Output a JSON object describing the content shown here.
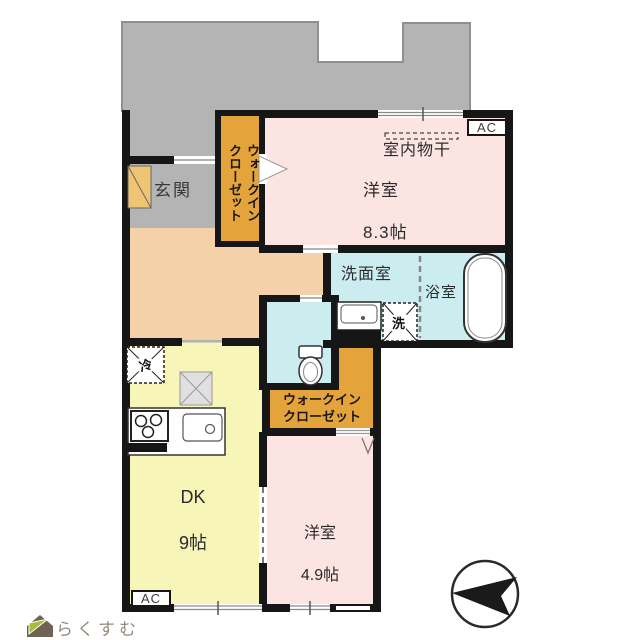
{
  "plan": {
    "type": "floor-plan",
    "labels": {
      "entrance": "玄関",
      "walk_in_closet_1": "ウォークイン\nクローゼット",
      "indoor_drying": "室内物干",
      "bedroom1_name": "洋室",
      "bedroom1_size": "8.3帖",
      "washroom": "洗面室",
      "bathroom": "浴室",
      "walk_in_closet_2": "ウォークイン\nクローゼット",
      "dk_name": "DK",
      "dk_size": "9帖",
      "bedroom2_name": "洋室",
      "bedroom2_size": "4.9帖",
      "ac_unit": "AC",
      "washer": "洗",
      "fridge": "冷",
      "brand": "らくすむ"
    },
    "rooms": [
      {
        "name": "洋室",
        "size": "8.3帖",
        "note": "室内物干"
      },
      {
        "name": "DK",
        "size": "9帖"
      },
      {
        "name": "洋室",
        "size": "4.9帖"
      },
      {
        "name": "ウォークインクローゼット",
        "count": 2
      },
      {
        "name": "玄関"
      },
      {
        "name": "洗面室"
      },
      {
        "name": "浴室"
      }
    ],
    "fixtures": [
      "bathtub",
      "toilet",
      "vanity-sink",
      "washer-space",
      "fridge-space",
      "stove",
      "kitchen-sink",
      "shoe-cabinet",
      "compass",
      "ac-unit",
      "ac-unit"
    ],
    "colors": {
      "wall": "#161616",
      "balcony": "#b4b4b4",
      "hallway": "#f4d1a9",
      "bedroom": "#fbe4e2",
      "wet_area": "#cbedf0",
      "dk": "#f7f5b7",
      "closet": "#e5a33b",
      "shoe_cabinet": "#efc573",
      "hatch": "#e0e0e0",
      "logo_green": "#a8bd3c",
      "logo_body": "#6e6355",
      "logo_text": "#938b7d"
    }
  }
}
